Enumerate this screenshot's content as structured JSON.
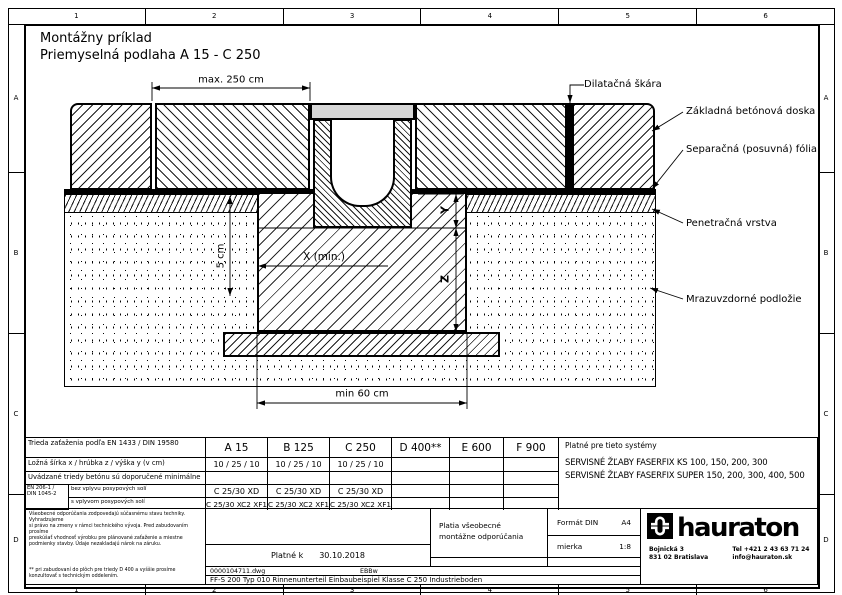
{
  "colors": {
    "line": "#000000",
    "grating_fill": "#d6d6d6"
  },
  "ruler": {
    "top": [
      "1",
      "2",
      "3",
      "4",
      "5",
      "6"
    ],
    "bottom": [
      "1",
      "2",
      "3",
      "4",
      "5",
      "6"
    ],
    "left": [
      "A",
      "B",
      "C",
      "D"
    ],
    "right": [
      "A",
      "B",
      "C",
      "D"
    ]
  },
  "title": {
    "line1": "Montážny príklad",
    "line2": "Priemyselná podlaha A 15 - C 250"
  },
  "dimensions": {
    "joint_spacing": "max. 250 cm",
    "x_min": "X (min.)",
    "strip": "5 cm",
    "y": "Y",
    "z": "Z",
    "trench_width": "min 60 cm"
  },
  "callouts": {
    "joint": "Dilatačná škára",
    "slab": "Základná betónová doska",
    "foil": "Separačná (posuvná) fólia",
    "primer": "Penetračná vrstva",
    "subbase": "Mrazuvzdorné podložie"
  },
  "load_table": {
    "class_row_label": "Trieda zaťaženia podľa EN 1433 / DIN 19580",
    "classes": [
      "A 15",
      "B 125",
      "C 250",
      "D 400**",
      "E 600",
      "F 900"
    ],
    "dims_row_label": "Ložná šírka x / hrúbka z / výška y (v cm)",
    "dims_values": [
      "10 / 25 / 10",
      "10 / 25 / 10",
      "10 / 25 / 10"
    ],
    "note_row_label": "Uvádzané triedy betónu sú doporučené minimálne",
    "norm_line1": "EN 206-1 /",
    "norm_line2": "DIN 1045-2",
    "concrete_row1_label": "bez vplyvu posypových solí",
    "concrete_row1_values": [
      "C 25/30 XD",
      "C 25/30 XD",
      "C 25/30 XD"
    ],
    "concrete_row2_label": "s vplyvom posypových solí",
    "concrete_row2_values": [
      "C 25/30 XC2  XF1",
      "C 25/30 XC2  XF1",
      "C 25/30 XC2  XF1"
    ],
    "systems_title": "Platné pre tieto systémy",
    "systems": [
      "SERVISNÉ ŽĽABY FASERFIX KS 100, 150, 200, 300",
      "SERVISNÉ ŽĽABY FASERFIX SUPER 150, 200, 300, 400, 500"
    ]
  },
  "title_block": {
    "disclaimer_lines": [
      "Všeobecné odporúčania zodpovedajú súčasnému stavu techniky. Vyhradzujeme",
      "si právo na zmeny v rámci technického vývoja. Pred zabudovaním prosíme",
      "preskúšať vhodnosť výrobku pre plánované zaťaženie a miestne",
      "podmienky stavby. Údaje nezakladajú nárok na záruku."
    ],
    "footnote_lines": [
      "** pri zabudovaní do plôch pre triedy D 400 a vyššie prosíme",
      "konzultovať s technickým oddelením."
    ],
    "valid_label": "Platné k",
    "valid_date": "30.10.2018",
    "note_line1": "Platia všeobecné",
    "note_line2": "montážne odporúčania",
    "format_label": "Formát DIN",
    "format_value": "A4",
    "scale_label": "mierka",
    "scale_value": "1:8",
    "file_name": "0000104711.dwg",
    "author": "EBBw",
    "doc_title": "FF-S 200 Typ 010 Rinnenunterteil Einbaubeispiel Klasse C 250 Industrieboden",
    "brand_name": "hauraton",
    "address1": "Bojnická 3",
    "address2": "831 02 Bratislava",
    "phone": "Tel +421 2 43 63 71 24",
    "email": "info@hauraton.sk"
  }
}
